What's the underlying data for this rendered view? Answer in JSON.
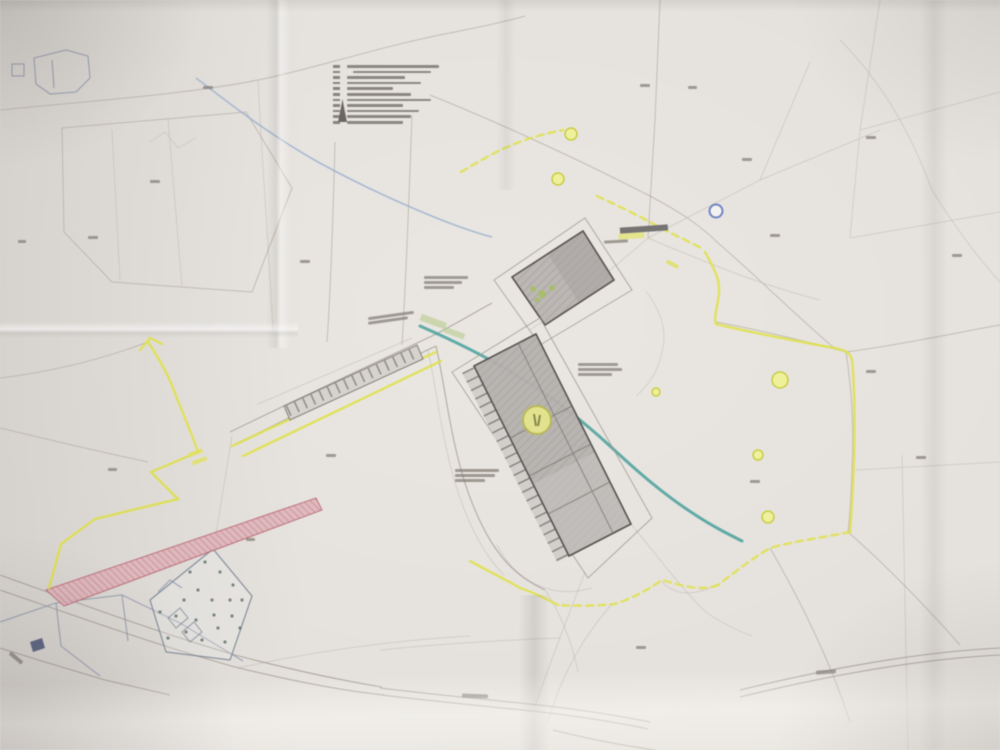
{
  "document_type": "photographed paper site plan (cadastral planning map), folded sheet",
  "text_legibility": "all map text and legend text too small/blurred to read",
  "palette": {
    "paper": "#e6e3df",
    "parcel_lines": "#b3aaa1",
    "planning_boundary_yellow": "#dfe04b",
    "stream_teal": "#47a09a",
    "stream_blue": "#9db2cf",
    "building_fill": "#b5b1ae",
    "building_outline": "#55514e",
    "road_widening_strip_pink": "#ddb3b8",
    "strip_hatch_red": "#c4717c",
    "marker_yellow": "#eef099",
    "marker_blue_ring": "#6d86c4",
    "orchard_outline_bluegray": "#7b8795"
  },
  "legend": {
    "position": "top-center of sheet",
    "row_count": 11,
    "rows": [
      {
        "symbol": "#6f6a64",
        "w": 92
      },
      {
        "symbol": "#6f6a64",
        "w": 78
      },
      {
        "symbol": "#6f6a64",
        "w": 58
      },
      {
        "symbol": "#6f6a64",
        "w": 74
      },
      {
        "symbol": "#6f6a64",
        "w": 46
      },
      {
        "symbol": "#6f6a64",
        "w": 64
      },
      {
        "symbol": "#6f6a64",
        "w": 84
      },
      {
        "symbol": "#6f6a64",
        "w": 56
      },
      {
        "symbol": "#6f6a64",
        "w": 72
      },
      {
        "symbol": "#6f6a64",
        "w": 64
      },
      {
        "symbol": "#6f6a64",
        "w": 56
      }
    ],
    "has_tower_mast_symbol": true
  },
  "map_features": [
    "faint-parcel-boundary-network",
    "yellow-planning-area-boundary",
    "main-building-hatched",
    "secondary-building-hatched",
    "parking-stall-row",
    "outer-yard-outlines",
    "teal-stream-line",
    "blue-stream-line",
    "pink-hatched-road-widening-strip",
    "dotted-orchard-parcel",
    "bottom-roads-double-line",
    "fold-creases-and-shadows"
  ],
  "markers": {
    "yellow_circle_positions": [
      [
        571,
        134
      ],
      [
        558,
        179
      ],
      [
        537,
        420
      ],
      [
        780,
        380
      ],
      [
        758,
        455
      ],
      [
        768,
        517
      ]
    ],
    "large_yellow_circle": [
      537,
      420
    ],
    "blue_circle_position": [
      716,
      211
    ],
    "dark_gray_bar_position": [
      620,
      227
    ]
  },
  "illegible_label_marks": [
    [
      424,
      276,
      44,
      0,
      3
    ],
    [
      424,
      281,
      38,
      0,
      3
    ],
    [
      424,
      286,
      30,
      0,
      3
    ],
    [
      368,
      314,
      46,
      -8,
      3
    ],
    [
      368,
      319,
      40,
      -8,
      3
    ],
    [
      578,
      363,
      40,
      0,
      3
    ],
    [
      578,
      368,
      44,
      0,
      3
    ],
    [
      578,
      373,
      34,
      0,
      3
    ],
    [
      455,
      469,
      44,
      0,
      3
    ],
    [
      455,
      474,
      40,
      0,
      3
    ],
    [
      455,
      479,
      30,
      0,
      3
    ],
    [
      604,
      240,
      24,
      -3,
      3
    ],
    [
      462,
      694,
      26,
      2,
      4
    ],
    [
      816,
      670,
      20,
      -4,
      4
    ],
    [
      8,
      656,
      16,
      40,
      4
    ],
    [
      203,
      86,
      10,
      0,
      3
    ],
    [
      150,
      180,
      10,
      0,
      3
    ],
    [
      88,
      236,
      10,
      0,
      3
    ],
    [
      18,
      240,
      8,
      0,
      3
    ],
    [
      300,
      260,
      10,
      0,
      3
    ],
    [
      640,
      84,
      10,
      0,
      3
    ],
    [
      688,
      86,
      9,
      0,
      3
    ],
    [
      742,
      158,
      10,
      0,
      3
    ],
    [
      866,
      136,
      10,
      0,
      3
    ],
    [
      952,
      254,
      10,
      0,
      3
    ],
    [
      770,
      234,
      10,
      0,
      3
    ],
    [
      866,
      370,
      10,
      0,
      3
    ],
    [
      916,
      456,
      10,
      0,
      3
    ],
    [
      750,
      480,
      10,
      0,
      3
    ],
    [
      636,
      646,
      10,
      0,
      3
    ],
    [
      326,
      454,
      10,
      0,
      3
    ],
    [
      246,
      538,
      9,
      0,
      3
    ],
    [
      108,
      468,
      9,
      0,
      3
    ]
  ]
}
